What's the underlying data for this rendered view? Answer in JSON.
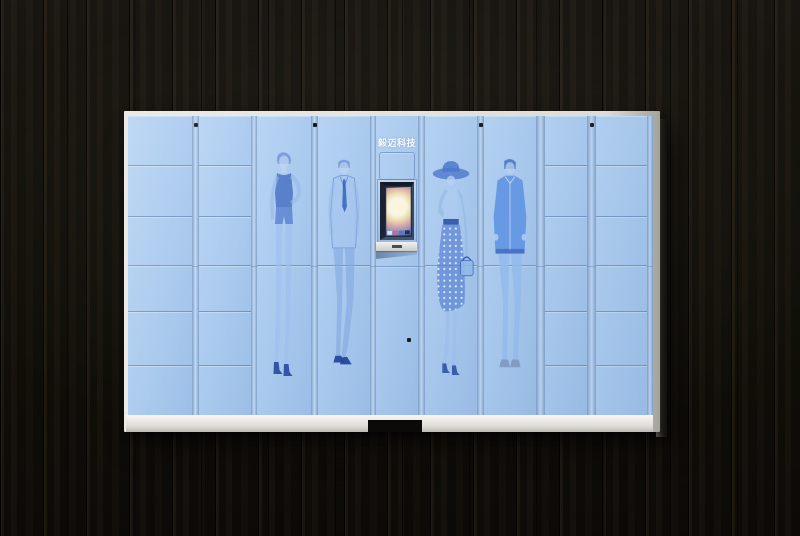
{
  "cabinet": {
    "brand_label": "毅迈科技",
    "figures": [
      {
        "id": "woman-dress",
        "label": "fashion sketch - woman in dress"
      },
      {
        "id": "man-suit",
        "label": "fashion sketch - man in suit"
      },
      {
        "id": "woman-hat",
        "label": "fashion sketch - woman with sun hat"
      },
      {
        "id": "man-jacket",
        "label": "fashion sketch - man in jacket"
      }
    ],
    "locker_row_heights": [
      50,
      51,
      49,
      46,
      54,
      49
    ],
    "screen": {
      "state": "on"
    },
    "colors": {
      "door": "#a9c9ee",
      "door_light": "#b6d3f3",
      "door_seam": "#6f9cce",
      "artwork": "#4f82d2",
      "artwork_dark": "#2f55a8",
      "frame": "#dcdcd8",
      "base": "#efeeea",
      "background": "#12100d",
      "screen_glow": "#fdf6e0"
    }
  }
}
